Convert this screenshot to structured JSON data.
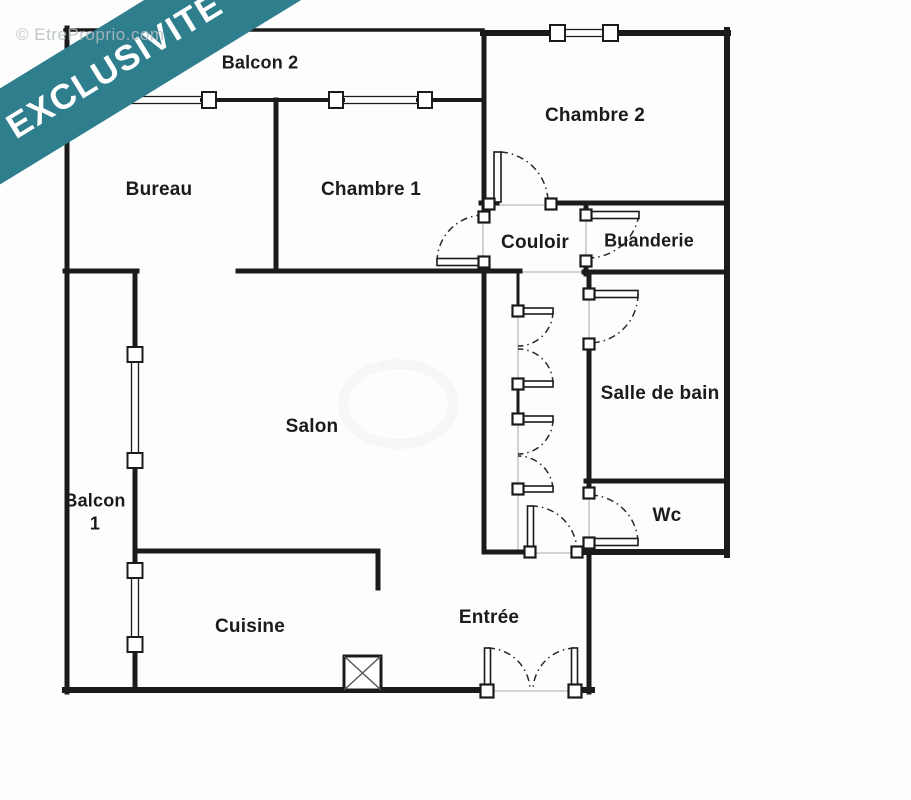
{
  "banner": {
    "label": "EXCLUSIVITÉ",
    "color": "#2e7e8e"
  },
  "watermark": {
    "label": "© EtreProprio.com"
  },
  "plan": {
    "rooms": [
      {
        "id": "balcon-2",
        "label": "Balcon 2"
      },
      {
        "id": "bureau",
        "label": "Bureau"
      },
      {
        "id": "chambre-1",
        "label": "Chambre 1"
      },
      {
        "id": "chambre-2",
        "label": "Chambre 2"
      },
      {
        "id": "couloir",
        "label": "Couloir"
      },
      {
        "id": "buanderie",
        "label": "Buanderie"
      },
      {
        "id": "salle-de-bain",
        "label": "Salle de bain"
      },
      {
        "id": "salon",
        "label": "Salon"
      },
      {
        "id": "balcon-1",
        "line1": "Balcon",
        "line2": "1"
      },
      {
        "id": "wc",
        "label": "Wc"
      },
      {
        "id": "cuisine",
        "label": "Cuisine"
      },
      {
        "id": "entree",
        "label": "Entrée"
      }
    ],
    "colors": {
      "wall": "#1b1b1b",
      "threshold": "#cdcdcd"
    }
  }
}
